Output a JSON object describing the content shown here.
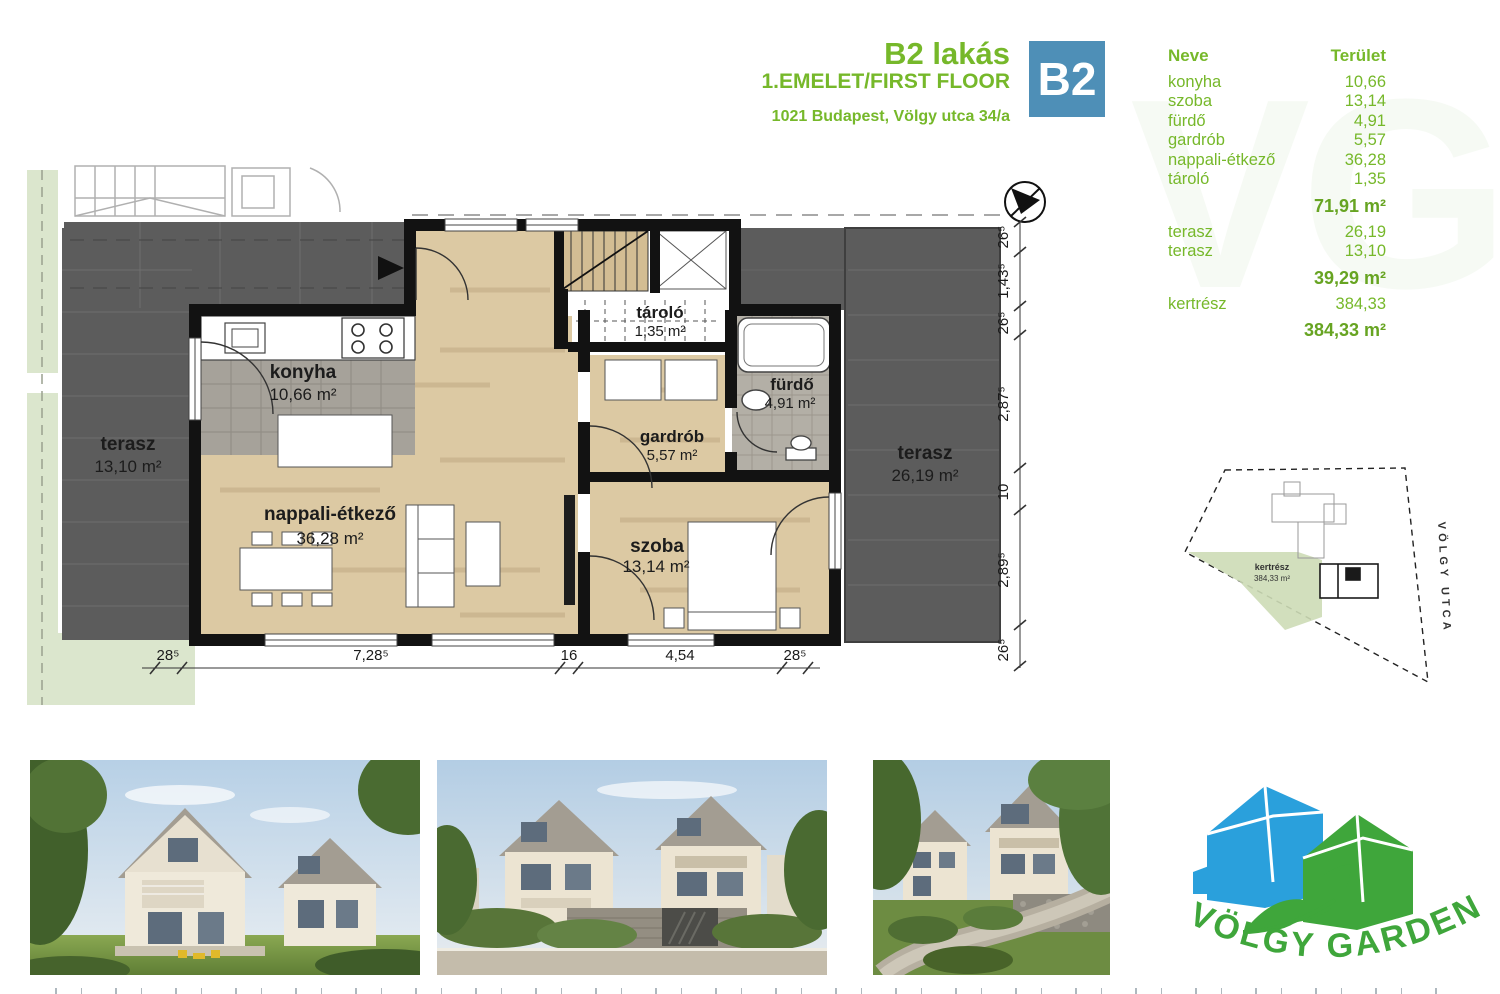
{
  "header": {
    "title": "B2 lakás",
    "subtitle": "1.EMELET/FIRST FLOOR",
    "address": "1021 Budapest, Völgy utca 34/a",
    "unit_badge": "B2"
  },
  "colors": {
    "brand_green": "#76b82a",
    "brand_green_dark": "#67a422",
    "badge_blue": "#4e8fb7",
    "logo_blue": "#2aa0dc",
    "logo_green": "#3fa63b",
    "terrace_gray": "#5c5c5c",
    "wood_floor": "#dcc9a3",
    "wall_black": "#121212",
    "garden_green": "#dbe6cd"
  },
  "area_table": {
    "headers": {
      "name": "Neve",
      "area": "Terület"
    },
    "rooms": [
      {
        "name": "konyha",
        "area": "10,66"
      },
      {
        "name": "szoba",
        "area": "13,14"
      },
      {
        "name": "fürdő",
        "area": "4,91"
      },
      {
        "name": "gardrób",
        "area": "5,57"
      },
      {
        "name": "nappali-étkező",
        "area": "36,28"
      },
      {
        "name": "tároló",
        "area": "1,35"
      }
    ],
    "rooms_total": "71,91 m²",
    "terraces": [
      {
        "name": "terasz",
        "area": "26,19"
      },
      {
        "name": "terasz",
        "area": "13,10"
      }
    ],
    "terraces_total": "39,29 m²",
    "garden": {
      "name": "kertrész",
      "area": "384,33"
    },
    "garden_total": "384,33 m²"
  },
  "floor_plan": {
    "rooms": [
      {
        "name": "konyha",
        "area": "10,66 m²"
      },
      {
        "name": "nappali-étkező",
        "area": "36,28 m²"
      },
      {
        "name": "tároló",
        "area": "1,35 m²"
      },
      {
        "name": "gardrób",
        "area": "5,57 m²"
      },
      {
        "name": "fürdő",
        "area": "4,91 m²"
      },
      {
        "name": "szoba",
        "area": "13,14 m²"
      },
      {
        "name": "terasz",
        "area": "13,10 m²"
      },
      {
        "name": "terasz",
        "area": "26,19 m²"
      }
    ],
    "dims_bottom": [
      "28⁵",
      "7,28⁵",
      "16",
      "4,54",
      "28⁵"
    ],
    "dims_right": [
      "26⁵",
      "1,43⁵",
      "26⁵",
      "2,87⁵",
      "10",
      "2,89⁵",
      "26⁵"
    ]
  },
  "site_plan": {
    "garden_label": "kertrész",
    "garden_area": "384,33 m²",
    "street": "VÖLGY UTCA"
  },
  "logo": {
    "text": "VÖLGY GARDEN"
  },
  "watermark": "VG"
}
